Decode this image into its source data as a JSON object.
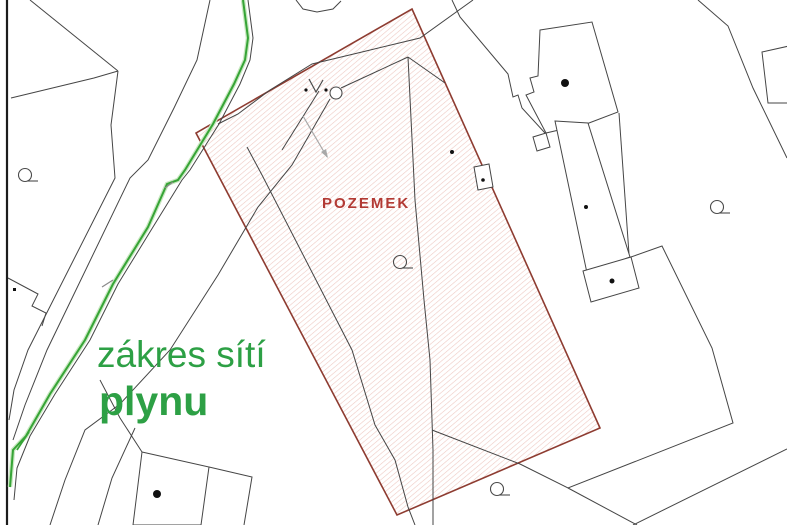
{
  "map": {
    "labels": {
      "parcel": "POZEMEK",
      "legend_line1": "zákres sítí",
      "legend_line2": "plynu"
    },
    "colors": {
      "background": "#ffffff",
      "frame": "#1c1c1c",
      "line": "#454545",
      "parcel_border": "#8e3c31",
      "hatch": "#eec9c3",
      "parcel_label": "#b23a34",
      "legend_text": "#2da045",
      "gas_line": "#36a436",
      "gas_halo": "#c8e8c0",
      "tick": "#8a8a8a",
      "arrow": "#a8a8a8",
      "symbol": "#4a4a4a",
      "building_fill": "#ffffff"
    },
    "frame_line": [
      [
        7,
        0
      ],
      [
        7,
        525
      ]
    ],
    "parcel_polygon": [
      [
        412,
        9
      ],
      [
        600,
        428
      ],
      [
        397,
        515
      ],
      [
        196,
        133
      ]
    ],
    "black_lines": [
      [
        [
          30,
          0
        ],
        [
          118,
          71
        ]
      ],
      [
        [
          118,
          71
        ],
        [
          94,
          78
        ],
        [
          11,
          98
        ]
      ],
      [
        [
          118,
          71
        ],
        [
          111,
          125
        ],
        [
          115,
          178
        ],
        [
          28,
          350
        ],
        [
          14,
          390
        ],
        [
          9,
          420
        ]
      ],
      [
        [
          210,
          0
        ],
        [
          197,
          60
        ],
        [
          174,
          108
        ],
        [
          148,
          160
        ],
        [
          130,
          178
        ],
        [
          47,
          350
        ],
        [
          25,
          405
        ],
        [
          13,
          440
        ]
      ],
      [
        [
          248,
          0
        ],
        [
          253,
          38
        ],
        [
          250,
          60
        ],
        [
          240,
          84
        ],
        [
          219,
          124
        ],
        [
          190,
          170
        ],
        [
          182,
          180
        ],
        [
          153,
          227
        ],
        [
          118,
          284
        ],
        [
          90,
          340
        ],
        [
          55,
          394
        ],
        [
          30,
          436
        ],
        [
          17,
          468
        ],
        [
          14,
          500
        ]
      ],
      [
        [
          330,
          99
        ],
        [
          292,
          165
        ],
        [
          258,
          207
        ],
        [
          218,
          275
        ],
        [
          170,
          350
        ],
        [
          120,
          404
        ],
        [
          85,
          430
        ],
        [
          65,
          480
        ],
        [
          50,
          525
        ]
      ],
      [
        [
          135,
          428
        ],
        [
          112,
          478
        ],
        [
          98,
          525
        ]
      ],
      [
        [
          473,
          0
        ],
        [
          420,
          38
        ],
        [
          362,
          52
        ],
        [
          312,
          64
        ],
        [
          270,
          90
        ],
        [
          238,
          114
        ],
        [
          218,
          124
        ]
      ],
      [
        [
          296,
          0
        ],
        [
          303,
          9
        ],
        [
          317,
          12
        ],
        [
          333,
          9
        ],
        [
          341,
          1
        ]
      ],
      [
        [
          341,
          88
        ],
        [
          408,
          57
        ]
      ],
      [
        [
          408,
          57
        ],
        [
          415,
          200
        ],
        [
          424,
          300
        ],
        [
          430,
          360
        ],
        [
          433,
          450
        ],
        [
          433,
          525
        ]
      ],
      [
        [
          408,
          57
        ],
        [
          445,
          83
        ]
      ],
      [
        [
          247,
          147
        ],
        [
          262,
          175
        ],
        [
          352,
          350
        ],
        [
          375,
          425
        ],
        [
          395,
          460
        ],
        [
          408,
          507
        ],
        [
          415,
          525
        ]
      ],
      [
        [
          319,
          91
        ],
        [
          282,
          150
        ]
      ],
      [
        [
          452,
          0
        ],
        [
          460,
          17
        ],
        [
          508,
          74
        ],
        [
          513,
          97
        ],
        [
          518,
          95
        ],
        [
          522,
          108
        ],
        [
          545,
          133
        ]
      ],
      [
        [
          698,
          0
        ],
        [
          728,
          26
        ],
        [
          753,
          88
        ],
        [
          787,
          158
        ]
      ],
      [
        [
          619,
          113
        ],
        [
          629,
          254
        ]
      ],
      [
        [
          631,
          257
        ],
        [
          662,
          246
        ],
        [
          712,
          348
        ],
        [
          733,
          423
        ],
        [
          568,
          488
        ],
        [
          520,
          464
        ],
        [
          432,
          430
        ]
      ],
      [
        [
          568,
          488
        ],
        [
          637,
          525
        ]
      ],
      [
        [
          787,
          449
        ],
        [
          633,
          525
        ]
      ],
      [
        [
          100,
          380
        ],
        [
          120,
          418
        ],
        [
          142,
          452
        ]
      ],
      [
        [
          209,
          467
        ],
        [
          252,
          477
        ],
        [
          244,
          525
        ]
      ],
      [
        [
          8,
          278
        ],
        [
          38,
          294
        ],
        [
          32,
          306
        ],
        [
          46,
          313
        ],
        [
          42,
          326
        ]
      ]
    ],
    "buildings": [
      {
        "name": "building-top-right",
        "points": [
          [
            540,
            30
          ],
          [
            592,
            22
          ],
          [
            618,
            112
          ],
          [
            589,
            123
          ],
          [
            546,
            133
          ],
          [
            526,
            95
          ],
          [
            534,
            92
          ],
          [
            530,
            78
          ],
          [
            538,
            76
          ]
        ]
      },
      {
        "name": "building-top-right-notch",
        "points": [
          [
            546,
            133
          ],
          [
            533,
            137
          ],
          [
            537,
            151
          ],
          [
            550,
            147
          ]
        ]
      },
      {
        "name": "building-strip",
        "points": [
          [
            555,
            121
          ],
          [
            588,
            123
          ],
          [
            630,
            257
          ],
          [
            587,
            273
          ]
        ]
      },
      {
        "name": "building-square",
        "points": [
          [
            583,
            271
          ],
          [
            631,
            257
          ],
          [
            639,
            288
          ],
          [
            591,
            302
          ]
        ]
      },
      {
        "name": "building-bottom",
        "points": [
          [
            142,
            452
          ],
          [
            209,
            467
          ],
          [
            201,
            525
          ],
          [
            133,
            525
          ]
        ]
      },
      {
        "name": "building-right-edge",
        "points": [
          [
            762,
            52
          ],
          [
            789,
            46
          ],
          [
            789,
            103
          ],
          [
            768,
            103
          ]
        ]
      },
      {
        "name": "building-tiny",
        "points": [
          [
            474,
            167
          ],
          [
            489,
            164
          ],
          [
            493,
            187
          ],
          [
            478,
            190
          ]
        ]
      }
    ],
    "dots": [
      {
        "x": 565,
        "y": 83,
        "r": 4
      },
      {
        "x": 157,
        "y": 494,
        "r": 4
      },
      {
        "x": 586,
        "y": 207,
        "r": 2
      },
      {
        "x": 612,
        "y": 281,
        "r": 2.5
      },
      {
        "x": 452,
        "y": 152,
        "r": 2
      },
      {
        "x": 483,
        "y": 180,
        "r": 1.8
      },
      {
        "x": 306,
        "y": 90,
        "r": 1.6
      },
      {
        "x": 326,
        "y": 90,
        "r": 1.6
      }
    ],
    "square_dots": [
      {
        "x": 13,
        "y": 288,
        "s": 3
      }
    ],
    "q_symbols": [
      {
        "cx": 25,
        "cy": 175
      },
      {
        "cx": 717,
        "cy": 207
      },
      {
        "cx": 400,
        "cy": 262
      },
      {
        "cx": 497,
        "cy": 489
      }
    ],
    "circle_symbol": {
      "cx": 336,
      "cy": 93,
      "r": 6
    },
    "v_symbol": [
      [
        309,
        79
      ],
      [
        316,
        92
      ],
      [
        323,
        80
      ]
    ],
    "arrow": {
      "line": [
        [
          303,
          116
        ],
        [
          327,
          157
        ]
      ],
      "head": [
        [
          328,
          158
        ],
        [
          326,
          149
        ],
        [
          321,
          152
        ]
      ]
    },
    "gas_line": [
      [
        243,
        0
      ],
      [
        248,
        38
      ],
      [
        245,
        60
      ],
      [
        234,
        84
      ],
      [
        213,
        124
      ],
      [
        185,
        170
      ],
      [
        178,
        180
      ],
      [
        167,
        184
      ],
      [
        148,
        227
      ],
      [
        113,
        284
      ],
      [
        85,
        340
      ],
      [
        50,
        394
      ],
      [
        26,
        436
      ],
      [
        13,
        450
      ],
      [
        10,
        487
      ]
    ],
    "gas_branch": [
      [
        29,
        432
      ],
      [
        17,
        450
      ]
    ],
    "tick_marks": [
      [
        [
          165,
          188
        ],
        [
          173,
          182
        ]
      ],
      [
        [
          102,
          287
        ],
        [
          113,
          280
        ]
      ]
    ]
  }
}
